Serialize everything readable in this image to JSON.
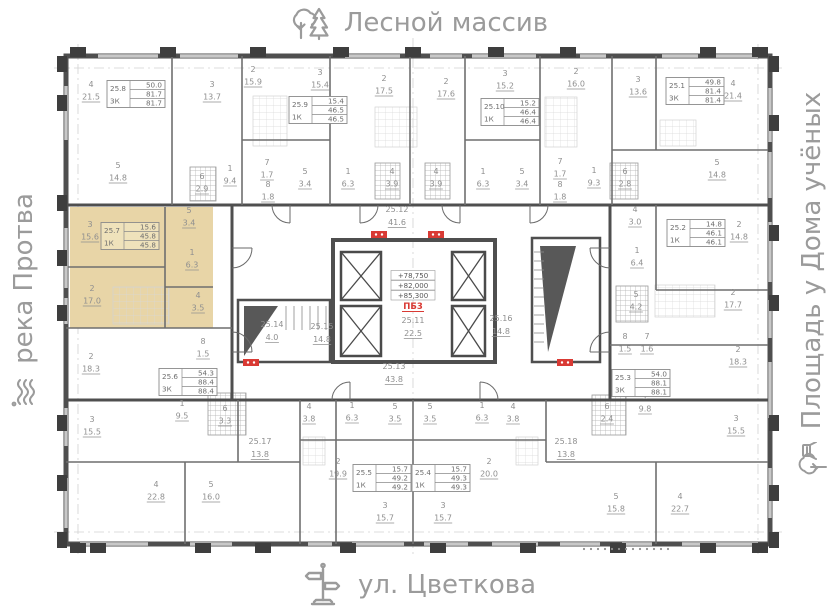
{
  "surroundings": {
    "north": {
      "label": "Лесной массив",
      "icon": "trees-icon"
    },
    "south": {
      "label": "ул. Цветкова",
      "icon": "street-sign-icon"
    },
    "west": {
      "label": "река Протва",
      "icon": "river-icon"
    },
    "east": {
      "label": "Площадь у Дома учёных",
      "icon": "park-icon"
    }
  },
  "colors": {
    "highlight": "#e8d5a7",
    "highlight_stat": "#efe2bb",
    "red": "#d93a34",
    "label": "#8f8f8f",
    "wall": "#4b4b4b"
  },
  "core": {
    "elevations": [
      "+78,750",
      "+82,000",
      "+85,300"
    ],
    "stair_block_label": "ПБ3"
  },
  "apartments": [
    {
      "unit": "25.8",
      "type": "3К",
      "living": "50.0",
      "area": "81.7",
      "total": "81.7",
      "x": 136,
      "y": 94,
      "highlighted": false
    },
    {
      "unit": "25.9",
      "type": "1К",
      "living": "15.4",
      "area": "46.5",
      "total": "46.5",
      "x": 318,
      "y": 110,
      "highlighted": false
    },
    {
      "unit": "25.10",
      "type": "1К",
      "living": "15.2",
      "area": "46.4",
      "total": "46.4",
      "x": 510,
      "y": 112,
      "highlighted": false
    },
    {
      "unit": "25.1",
      "type": "3К",
      "living": "49.8",
      "area": "81.4",
      "total": "81.4",
      "x": 695,
      "y": 91,
      "highlighted": false
    },
    {
      "unit": "25.7",
      "type": "1К",
      "living": "15.6",
      "area": "45.8",
      "total": "45.8",
      "x": 130,
      "y": 236,
      "highlighted": true
    },
    {
      "unit": "25.2",
      "type": "1К",
      "living": "14.8",
      "area": "46.1",
      "total": "46.1",
      "x": 696,
      "y": 233,
      "highlighted": false
    },
    {
      "unit": "25.6",
      "type": "3К",
      "living": "54.3",
      "area": "88.4",
      "total": "88.4",
      "x": 188,
      "y": 382,
      "highlighted": false
    },
    {
      "unit": "25.3",
      "type": "3К",
      "living": "54.0",
      "area": "88.1",
      "total": "88.1",
      "x": 641,
      "y": 383,
      "highlighted": false
    },
    {
      "unit": "25.5",
      "type": "1К",
      "living": "15.7",
      "area": "49.2",
      "total": "49.2",
      "x": 382,
      "y": 478,
      "highlighted": false
    },
    {
      "unit": "25.4",
      "type": "1К",
      "living": "15.7",
      "area": "49.3",
      "total": "49.3",
      "x": 441,
      "y": 478,
      "highlighted": false
    }
  ],
  "rooms": [
    {
      "n": "4",
      "a": "21.5",
      "x": 91,
      "y": 87
    },
    {
      "n": "3",
      "a": "13.7",
      "x": 212,
      "y": 87
    },
    {
      "n": "2",
      "a": "15.9",
      "x": 253,
      "y": 72
    },
    {
      "n": "3",
      "a": "15.4",
      "x": 320,
      "y": 75
    },
    {
      "n": "2",
      "a": "17.5",
      "x": 384,
      "y": 81
    },
    {
      "n": "2",
      "a": "17.6",
      "x": 446,
      "y": 84
    },
    {
      "n": "3",
      "a": "15.2",
      "x": 505,
      "y": 76
    },
    {
      "n": "2",
      "a": "16.0",
      "x": 576,
      "y": 74
    },
    {
      "n": "3",
      "a": "13.6",
      "x": 638,
      "y": 82
    },
    {
      "n": "4",
      "a": "21.4",
      "x": 733,
      "y": 86
    },
    {
      "n": "5",
      "a": "14.8",
      "x": 118,
      "y": 168
    },
    {
      "n": "6",
      "a": "2.9",
      "x": 202,
      "y": 179
    },
    {
      "n": "1",
      "a": "9.4",
      "x": 230,
      "y": 171
    },
    {
      "n": "7",
      "a": "1.7",
      "x": 267,
      "y": 165
    },
    {
      "n": "8",
      "a": "1.8",
      "x": 268,
      "y": 187
    },
    {
      "n": "5",
      "a": "3.4",
      "x": 305,
      "y": 174
    },
    {
      "n": "1",
      "a": "6.3",
      "x": 348,
      "y": 174
    },
    {
      "n": "4",
      "a": "3.9",
      "x": 392,
      "y": 174
    },
    {
      "n": "4",
      "a": "3.9",
      "x": 436,
      "y": 174
    },
    {
      "n": "1",
      "a": "6.3",
      "x": 483,
      "y": 174
    },
    {
      "n": "5",
      "a": "3.4",
      "x": 522,
      "y": 174
    },
    {
      "n": "7",
      "a": "1.7",
      "x": 560,
      "y": 164
    },
    {
      "n": "8",
      "a": "1.8",
      "x": 560,
      "y": 187
    },
    {
      "n": "1",
      "a": "9.3",
      "x": 594,
      "y": 173
    },
    {
      "n": "6",
      "a": "2.8",
      "x": 625,
      "y": 174
    },
    {
      "n": "5",
      "a": "14.8",
      "x": 717,
      "y": 165
    },
    {
      "n": "3",
      "a": "15.6",
      "x": 90,
      "y": 227
    },
    {
      "n": "5",
      "a": "3.4",
      "x": 189,
      "y": 213
    },
    {
      "n": "1",
      "a": "6.3",
      "x": 192,
      "y": 255
    },
    {
      "n": "2",
      "a": "17.0",
      "x": 92,
      "y": 291
    },
    {
      "n": "4",
      "a": "3.5",
      "x": 198,
      "y": 298
    },
    {
      "n": "4",
      "a": "3.0",
      "x": 635,
      "y": 212
    },
    {
      "n": "2",
      "a": "14.8",
      "x": 739,
      "y": 227
    },
    {
      "n": "1",
      "a": "6.4",
      "x": 637,
      "y": 253
    },
    {
      "n": "5",
      "a": "4.2",
      "x": 636,
      "y": 297
    },
    {
      "n": "2",
      "a": "17.7",
      "x": 733,
      "y": 295
    },
    {
      "n": "2",
      "a": "18.3",
      "x": 91,
      "y": 359
    },
    {
      "n": "8",
      "a": "1.5",
      "x": 203,
      "y": 344
    },
    {
      "n": "8",
      "a": "1.5",
      "x": 625,
      "y": 339
    },
    {
      "n": "7",
      "a": "1.6",
      "x": 647,
      "y": 339
    },
    {
      "n": "2",
      "a": "18.3",
      "x": 738,
      "y": 352
    },
    {
      "n": "1",
      "a": "9.5",
      "x": 182,
      "y": 406
    },
    {
      "n": "6",
      "a": "3.3",
      "x": 225,
      "y": 411
    },
    {
      "n": "3",
      "a": "15.5",
      "x": 92,
      "y": 422
    },
    {
      "n": "1",
      "a": "9.8",
      "x": 645,
      "y": 399
    },
    {
      "n": "6",
      "a": "2.4",
      "x": 607,
      "y": 409
    },
    {
      "n": "3",
      "a": "15.5",
      "x": 736,
      "y": 421
    },
    {
      "n": "4",
      "a": "22.8",
      "x": 156,
      "y": 487
    },
    {
      "n": "5",
      "a": "16.0",
      "x": 211,
      "y": 487
    },
    {
      "n": "4",
      "a": "3.8",
      "x": 309,
      "y": 409
    },
    {
      "n": "1",
      "a": "6.3",
      "x": 352,
      "y": 408
    },
    {
      "n": "5",
      "a": "3.5",
      "x": 395,
      "y": 409
    },
    {
      "n": "5",
      "a": "3.5",
      "x": 430,
      "y": 409
    },
    {
      "n": "1",
      "a": "6.3",
      "x": 482,
      "y": 408
    },
    {
      "n": "4",
      "a": "3.8",
      "x": 513,
      "y": 409
    },
    {
      "n": "2",
      "a": "19.9",
      "x": 338,
      "y": 464
    },
    {
      "n": "2",
      "a": "20.0",
      "x": 489,
      "y": 464
    },
    {
      "n": "3",
      "a": "15.7",
      "x": 385,
      "y": 508
    },
    {
      "n": "3",
      "a": "15.7",
      "x": 443,
      "y": 508
    },
    {
      "n": "5",
      "a": "15.8",
      "x": 616,
      "y": 499
    },
    {
      "n": "4",
      "a": "22.7",
      "x": 680,
      "y": 499
    }
  ],
  "commons": [
    {
      "name": "25.12",
      "a": "41.6",
      "x": 397,
      "y": 212
    },
    {
      "name": "25.11",
      "a": "22.5",
      "x": 413,
      "y": 323
    },
    {
      "name": "25.16",
      "a": "14.8",
      "x": 501,
      "y": 321
    },
    {
      "name": "25.14",
      "a": "4.0",
      "x": 272,
      "y": 327
    },
    {
      "name": "25.15",
      "a": "14.8",
      "x": 322,
      "y": 329
    },
    {
      "name": "25.13",
      "a": "43.8",
      "x": 394,
      "y": 369
    },
    {
      "name": "25.17",
      "a": "13.8",
      "x": 260,
      "y": 444
    },
    {
      "name": "25.18",
      "a": "13.8",
      "x": 566,
      "y": 444
    }
  ]
}
